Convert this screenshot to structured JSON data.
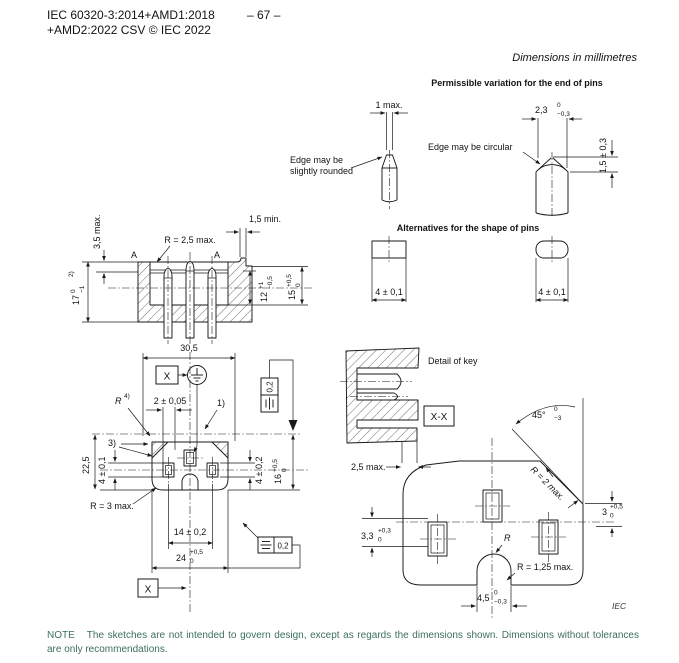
{
  "header": {
    "line1": "IEC 60320-3:2014+AMD1:2018",
    "line2": "+AMD2:2022 CSV © IEC 2022",
    "page": "– 67 –"
  },
  "units_note": "Dimensions in millimetres",
  "credit": "IEC",
  "note": {
    "label": "NOTE",
    "text": "The sketches are not intended to govern design, except as regards the dimensions shown. Dimensions without tolerances are only recommendations."
  },
  "colors": {
    "note_green": "#3d6f5c",
    "ink": "#131313"
  },
  "pin_variation": {
    "title": "Permissible variation for the end of pins",
    "one_max": "1 max.",
    "edge_rounded_line1": "Edge may be",
    "edge_rounded_line2": "slightly rounded",
    "edge_circular": "Edge may be circular",
    "d23": {
      "v": "2,3",
      "hi": "0",
      "lo": "−0,3"
    },
    "d15": "1,5 ± 0,3"
  },
  "pin_alternatives": {
    "title": "Alternatives for the shape of pins",
    "w_left": "4 ± 0,1",
    "w_right": "4 ± 0,1"
  },
  "section_view": {
    "a_left": "A",
    "a_right": "A",
    "r25": "R = 2,5 max.",
    "d35": "3,5 max.",
    "d15min": "1,5 min.",
    "d17": {
      "v": "17",
      "hi": "0",
      "lo": "−1",
      "note": "2)"
    },
    "d12": {
      "v": "12",
      "hi": "+1",
      "lo": "−0,5"
    },
    "d15": {
      "v": "15",
      "hi": "+0,5",
      "lo": "0"
    }
  },
  "front_view": {
    "d305": "30,5",
    "x_top": "X",
    "x_bottom": "X",
    "r4": {
      "v": "R",
      "note": "4)"
    },
    "d2": "2 ± 0,05",
    "n1": "1)",
    "n3": "3)",
    "d225": "22,5",
    "d4_left": "4 ± 0,1",
    "d4_right": "4 ± 0,2",
    "d16": {
      "v": "16",
      "hi": "+0,5",
      "lo": "0"
    },
    "r3": "R = 3 max.",
    "d14": "14 ± 0,2",
    "d24": {
      "v": "24",
      "hi": "+0,5",
      "lo": "0"
    },
    "fcf_vertical": "0,2",
    "fcf_horizontal": "0,2"
  },
  "key_detail": {
    "title": "Detail of key",
    "xx": "X-X",
    "d25max": "2,5 max."
  },
  "xx_view": {
    "d45deg": {
      "v": "45°",
      "hi": "0",
      "lo": "−3"
    },
    "r2": "R = 2 max.",
    "d3": {
      "v": "3",
      "hi": "+0,5",
      "lo": "0"
    },
    "d33": {
      "v": "3,3",
      "hi": "+0,3",
      "lo": "0"
    },
    "r": "R",
    "r125": "R = 1,25 max.",
    "d45": {
      "v": "4,5",
      "hi": "0",
      "lo": "−0,3"
    }
  }
}
